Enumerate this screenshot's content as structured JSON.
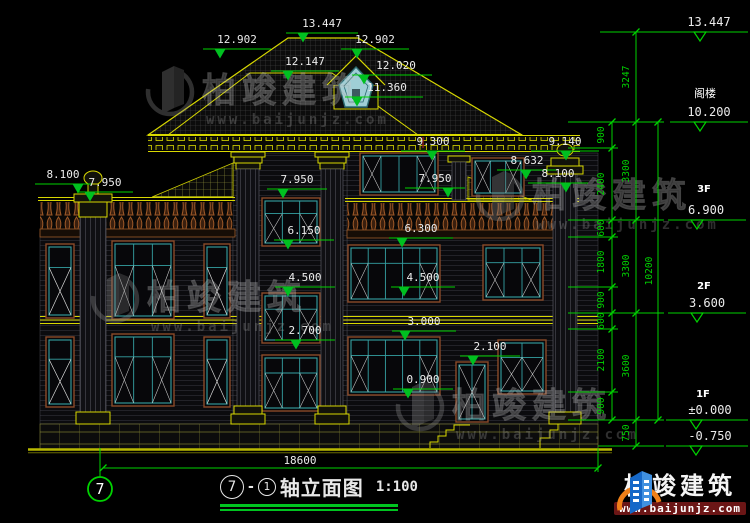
{
  "drawing": {
    "annotations": {
      "d13447": "13.447",
      "d12902": "12.902",
      "d12147": "12.147",
      "d12020": "12.020",
      "d11360": "11.360",
      "d9300": "9.300",
      "d9140": "9.140",
      "d8632": "8.632",
      "d8100": "8.100",
      "d7950": "7.950",
      "d6300": "6.300",
      "d6150": "6.150",
      "d4500": "4.500",
      "d3000": "3.000",
      "d2700": "2.700",
      "d2100": "2.100",
      "d0900": "0.900"
    },
    "levels": {
      "attic": "阁楼",
      "f3": "3F",
      "f2": "2F",
      "f1": "1F",
      "l13447": "13.447",
      "l10200": "10.200",
      "l6900": "6.900",
      "l3600": "3.600",
      "l0000": "±0.000",
      "ln0750": "-0.750"
    },
    "chain": {
      "c3247": "3247",
      "c900": "900",
      "c2400": "2400",
      "c600": "600",
      "c1800": "1800",
      "c2100": "2100",
      "c750": "750",
      "c3300": "3300",
      "c3600": "3600",
      "c10200": "10200"
    }
  },
  "footer": {
    "axis": "7",
    "overall": "18600",
    "bubble_main": "7",
    "dash": "-",
    "bubble_sub": "1",
    "title": "轴立面图",
    "scale": "1:100"
  },
  "brand": {
    "name": "柏竣建筑",
    "site": "www.baijunjz.com"
  },
  "watermark": {
    "name": "柏竣建筑",
    "site": "www.baijunjz.com"
  },
  "colors": {
    "background": "#000000",
    "dim_green": "#00d200",
    "cad_yellow": "#d8d800",
    "window_teal": "#35a2a4",
    "trim_brown": "#8a4a28",
    "logo_blue": "#1668c8",
    "logo_orange": "#f08018",
    "text_white": "#ececec"
  }
}
